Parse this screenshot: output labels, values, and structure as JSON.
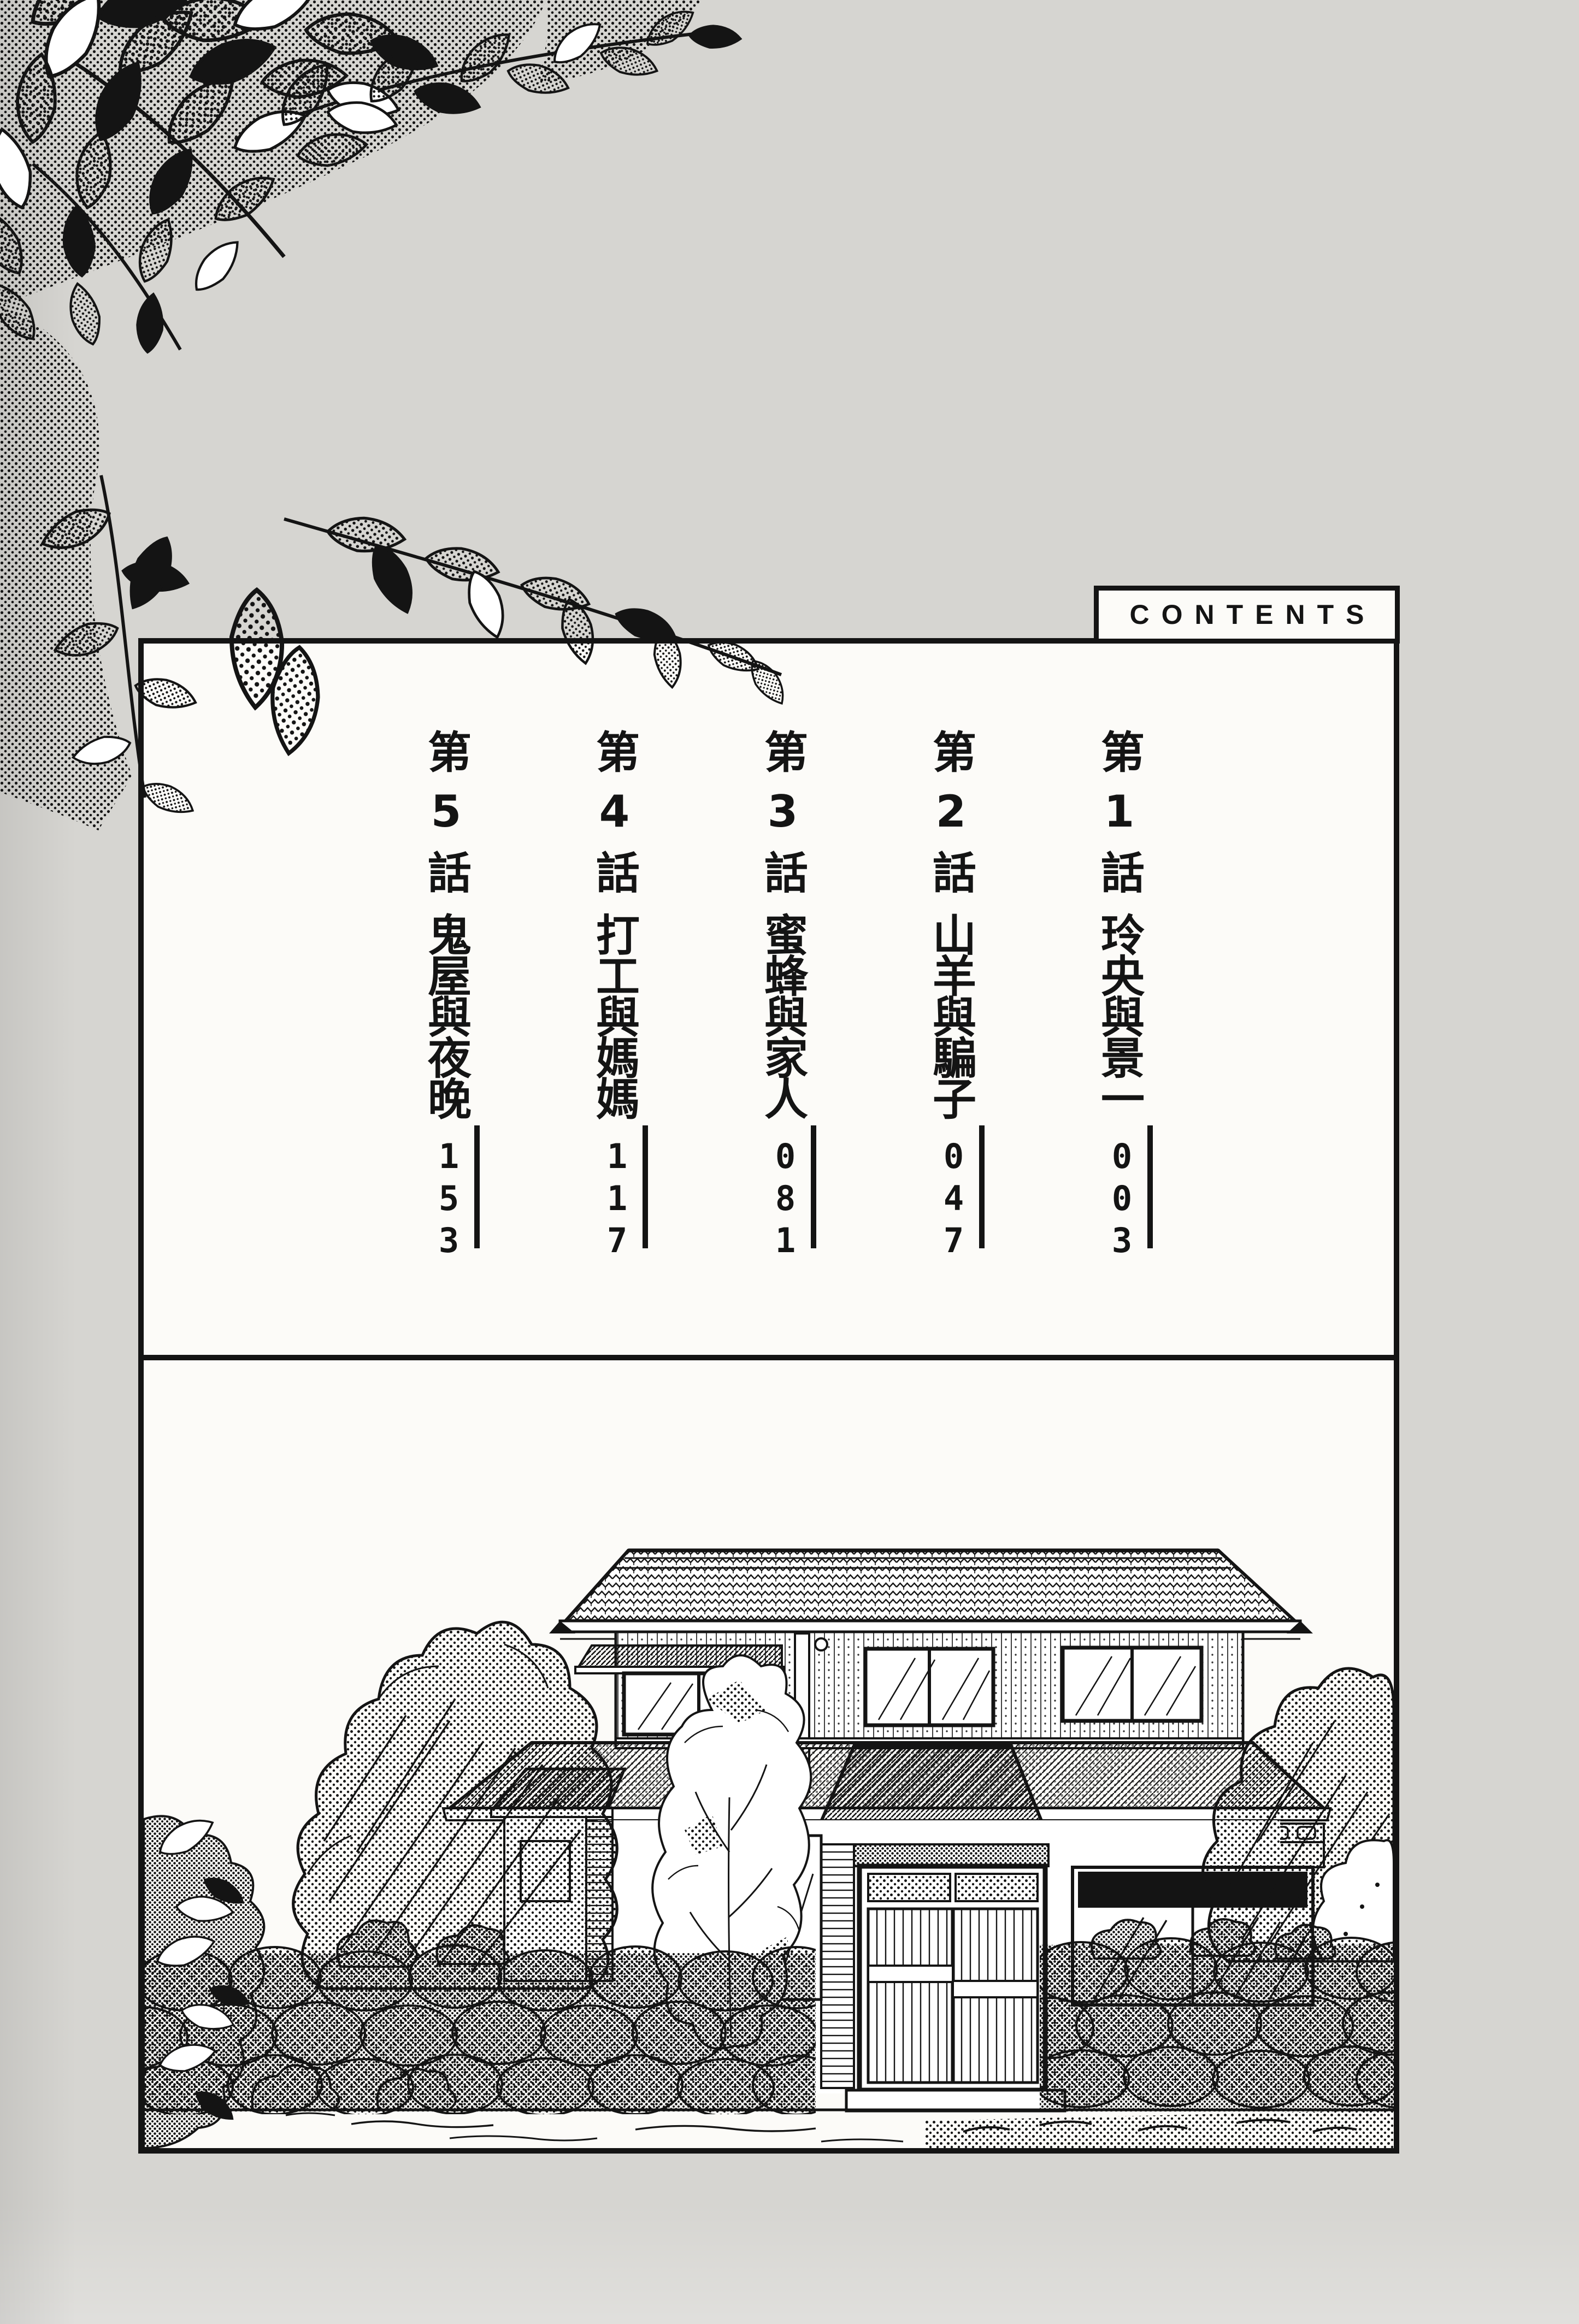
{
  "page": {
    "background_color": "#d6d5d1",
    "panel_background": "#fcfbf8",
    "ink_color": "#141414"
  },
  "contents": {
    "header": "CONTENTS",
    "entries": [
      {
        "chapter": "第1話",
        "title": "玲央與景一",
        "page": "003"
      },
      {
        "chapter": "第2話",
        "title": "山羊與騙子",
        "page": "047"
      },
      {
        "chapter": "第3話",
        "title": "蜜蜂與家人",
        "page": "081"
      },
      {
        "chapter": "第4話",
        "title": "打工與媽媽",
        "page": "117"
      },
      {
        "chapter": "第5話",
        "title": "鬼屋與夜晚",
        "page": "153"
      }
    ]
  },
  "illustrations": {
    "top_left": "leafy-branches-halftone",
    "bottom_panel": "two-story-japanese-house-with-stone-wall-and-trees"
  }
}
